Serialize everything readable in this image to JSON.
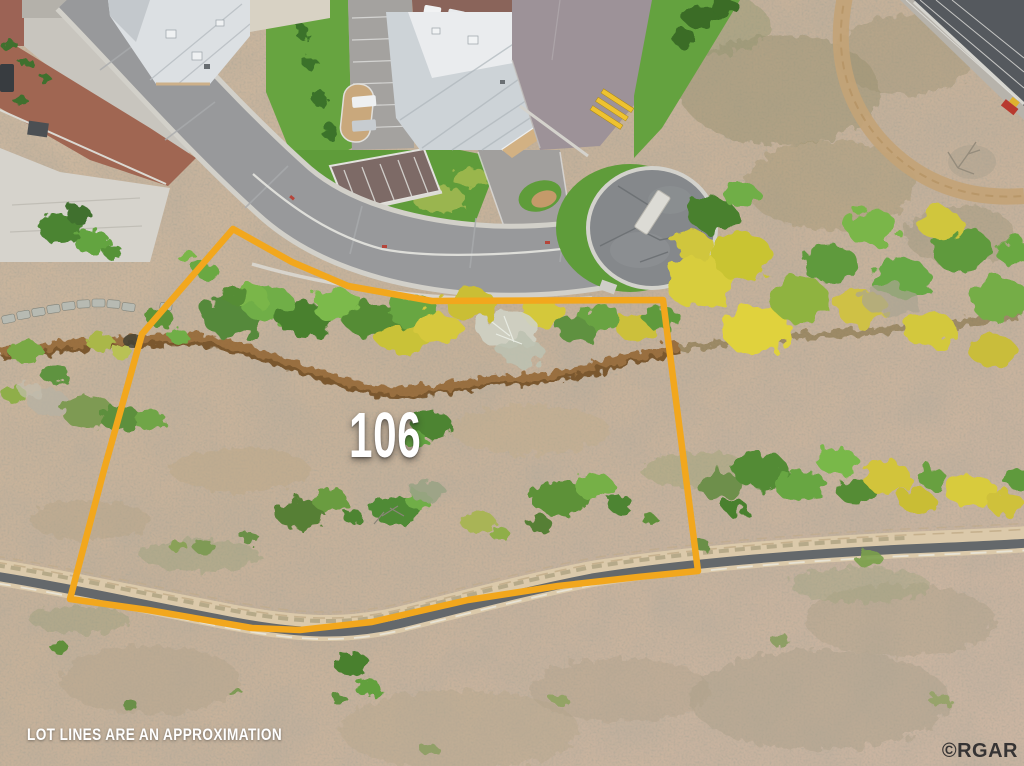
{
  "image": {
    "type": "aerial-drone-photo",
    "subject": "vacant land lot outlined for sale next to a cul-de-sac street, greenbelt trail and commercial buildings",
    "lot_number": "106",
    "disclaimer": "LOT LINES ARE AN APPROXIMATION",
    "watermark": "©RGAR",
    "lot_boundary_points": "233,229 292,262 348,286 432,301 663,300 698,571 638,577 558,586 468,600 372,622 300,630 252,628 148,610 70,599 104,470 142,334",
    "colors": {
      "lot_line": "#F2A71D",
      "dirt_scrub": "#C9B49C",
      "grass": "#5F9C3A",
      "road_asphalt": "#98999B",
      "cul_de_sac_asphalt": "#85888B",
      "trail_asphalt": "#64686B",
      "foliage_green": "#5E9140",
      "foliage_yellow": "#D4C63B",
      "creek_brush": "#8F5E2C",
      "label_text": "#FFFFFF",
      "watermark_text": "#1D1E22"
    }
  }
}
